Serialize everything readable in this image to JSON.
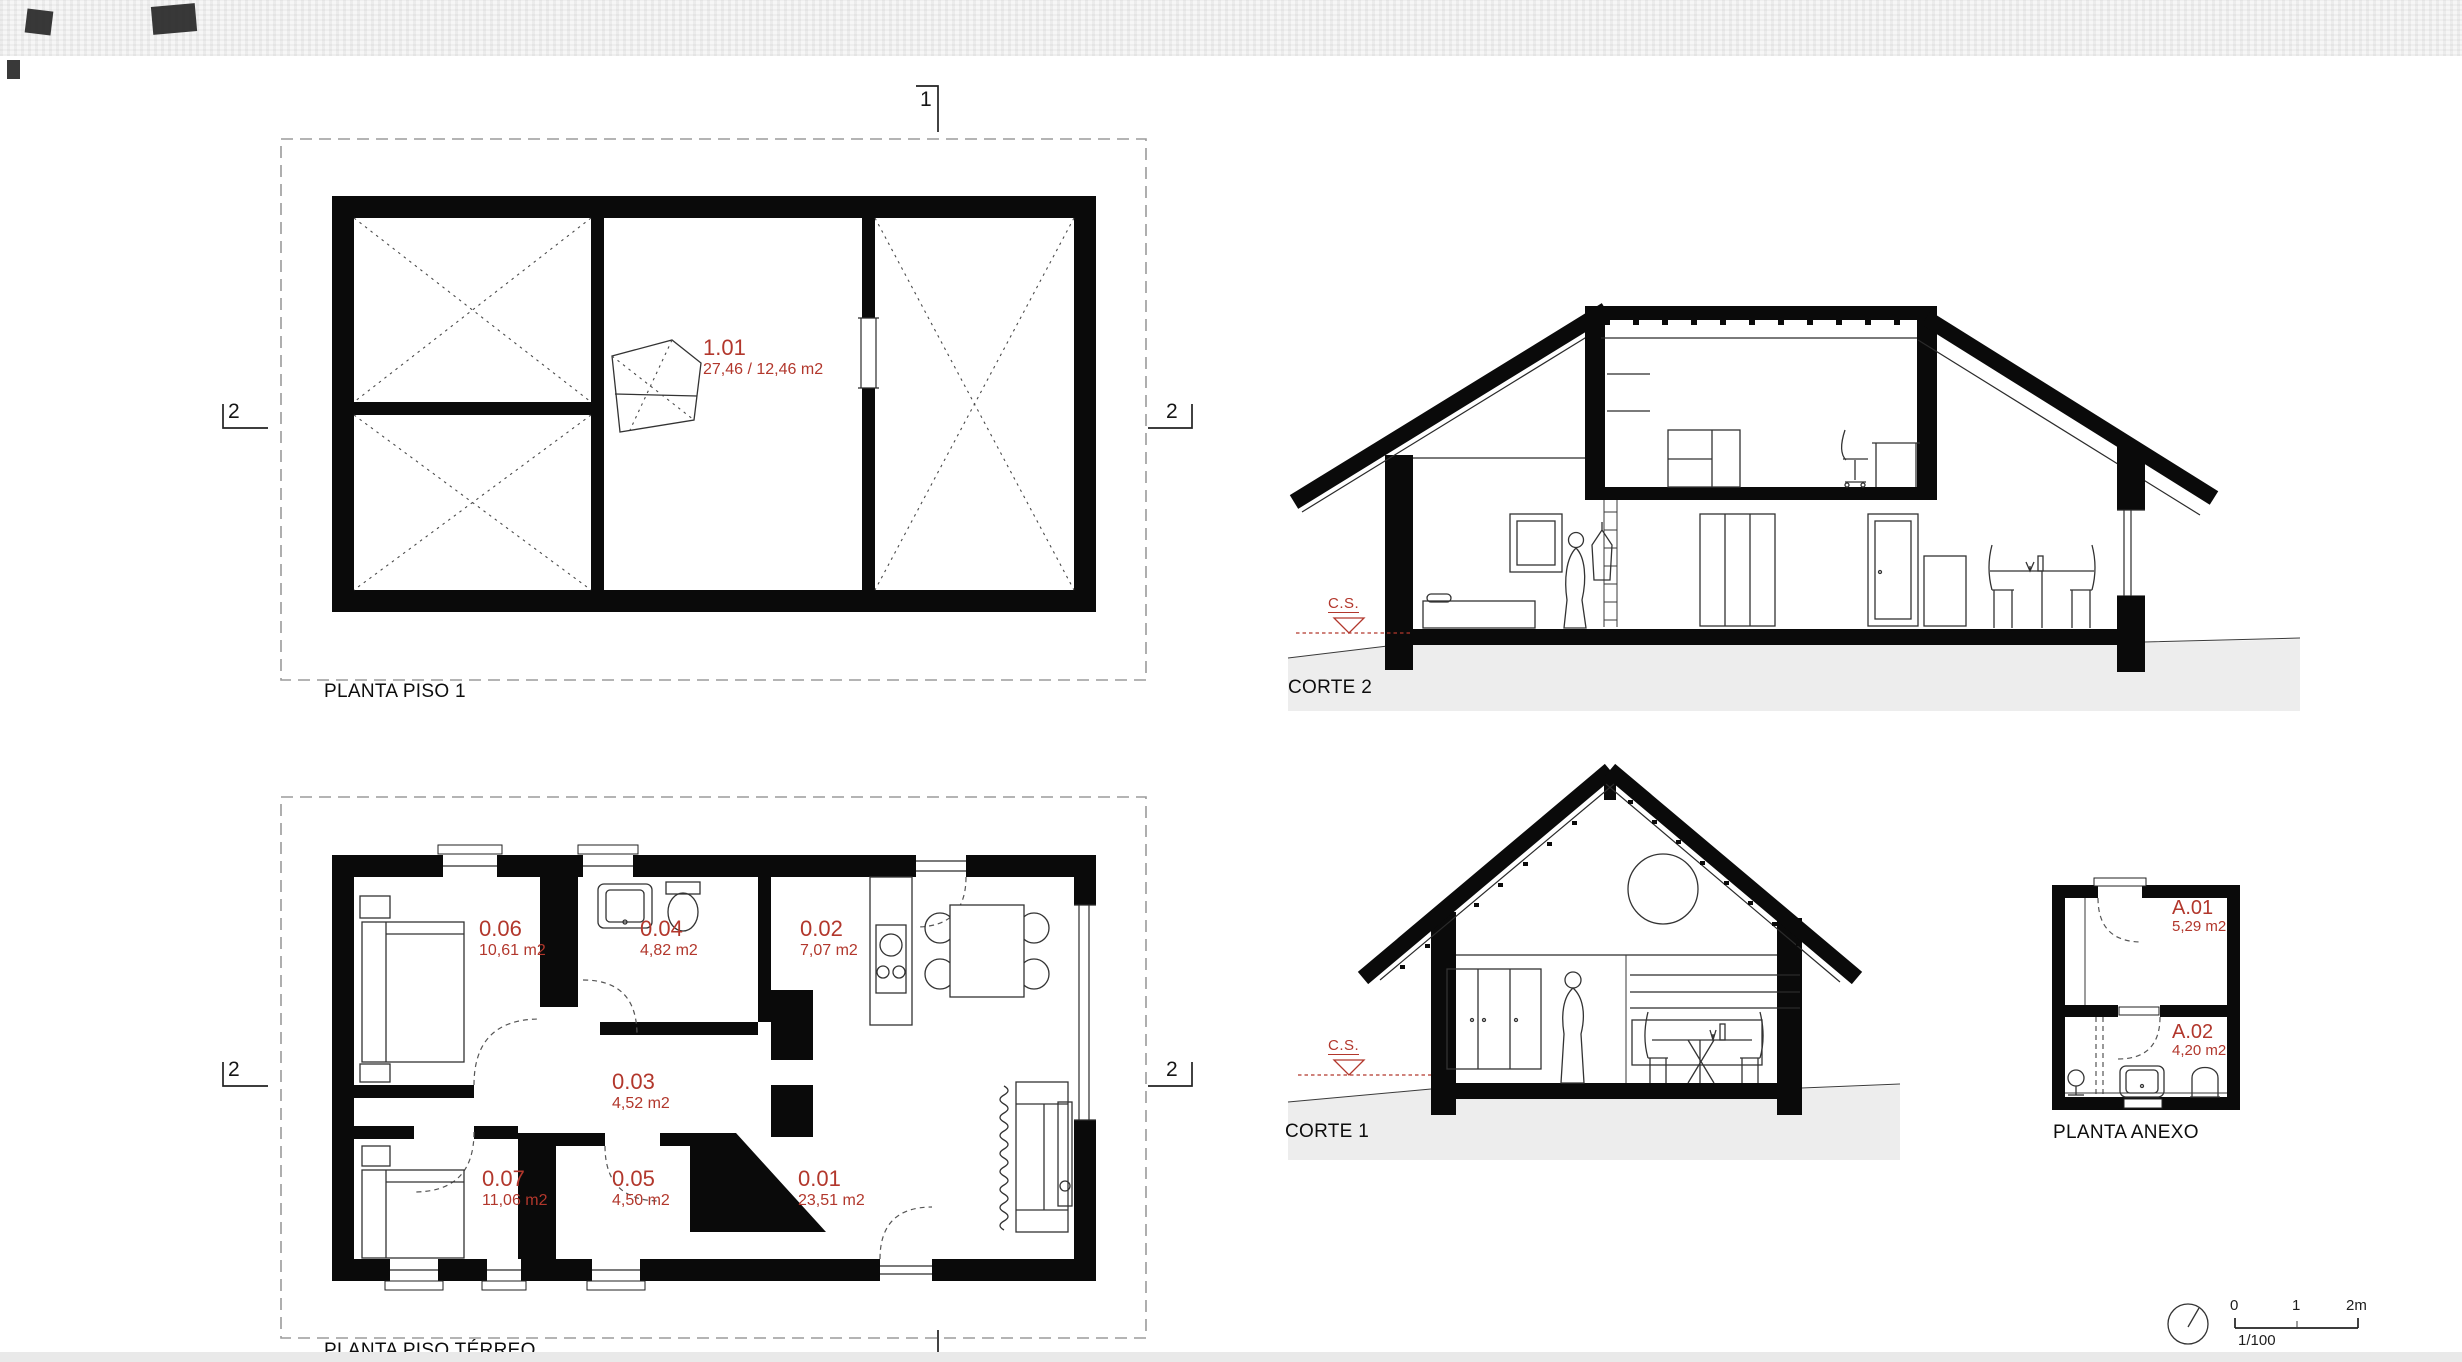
{
  "sheet": {
    "background": "#ffffff",
    "ground_fill": "#ededed",
    "accent_red": "#b2372c",
    "line_color": "#1a1a1a"
  },
  "planta_piso_1": {
    "title": "PLANTA PISO 1",
    "rooms": [
      {
        "id": "1.01",
        "area": "27,46 / 12,46 m2"
      }
    ]
  },
  "planta_piso_terreo": {
    "title": "PLANTA PISO TÉRREO",
    "rooms": [
      {
        "id": "0.01",
        "area": "23,51 m2"
      },
      {
        "id": "0.02",
        "area": "7,07 m2"
      },
      {
        "id": "0.03",
        "area": "4,52 m2"
      },
      {
        "id": "0.04",
        "area": "4,82 m2"
      },
      {
        "id": "0.05",
        "area": "4,50 m2"
      },
      {
        "id": "0.06",
        "area": "10,61 m2"
      },
      {
        "id": "0.07",
        "area": "11,06 m2"
      }
    ]
  },
  "corte_2": {
    "title": "CORTE 2",
    "level_marker": "C.S."
  },
  "corte_1": {
    "title": "CORTE 1",
    "level_marker": "C.S."
  },
  "planta_anexo": {
    "title": "PLANTA ANEXO",
    "rooms": [
      {
        "id": "A.01",
        "area": "5,29 m2"
      },
      {
        "id": "A.02",
        "area": "4,20 m2"
      }
    ]
  },
  "section_markers": {
    "top": "1",
    "upper_left": "2",
    "upper_right": "2",
    "lower_left": "2",
    "lower_right": "2"
  },
  "scale_bar": {
    "tick_0": "0",
    "tick_1": "1",
    "tick_2": "2m",
    "ratio": "1/100",
    "north_icon": "compass-circle"
  }
}
